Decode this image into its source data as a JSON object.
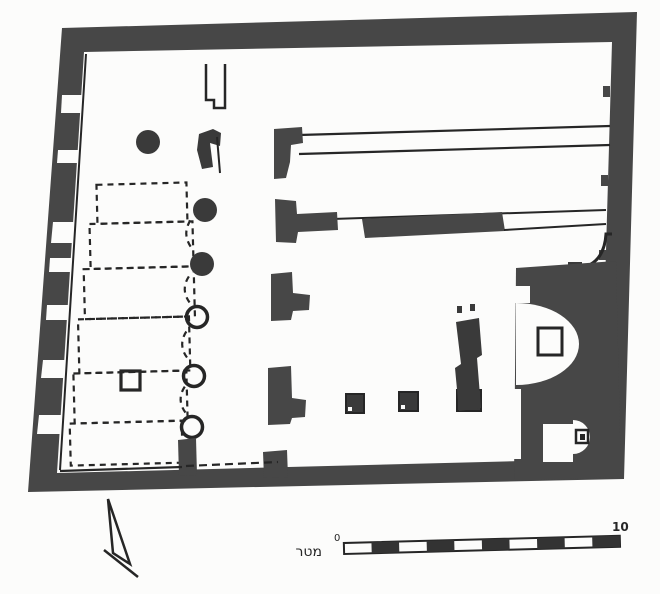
{
  "theme": {
    "colors": {
      "paper": "#fcfcfb",
      "ink": "#262626",
      "wall": "#474747",
      "dark-fill": "#3a3a3a"
    }
  },
  "scale_bar": {
    "zero_label": "0",
    "ten_label": "10",
    "unit_label": "מטר",
    "segment_count": 10,
    "pattern": "alternating white and black segments"
  }
}
